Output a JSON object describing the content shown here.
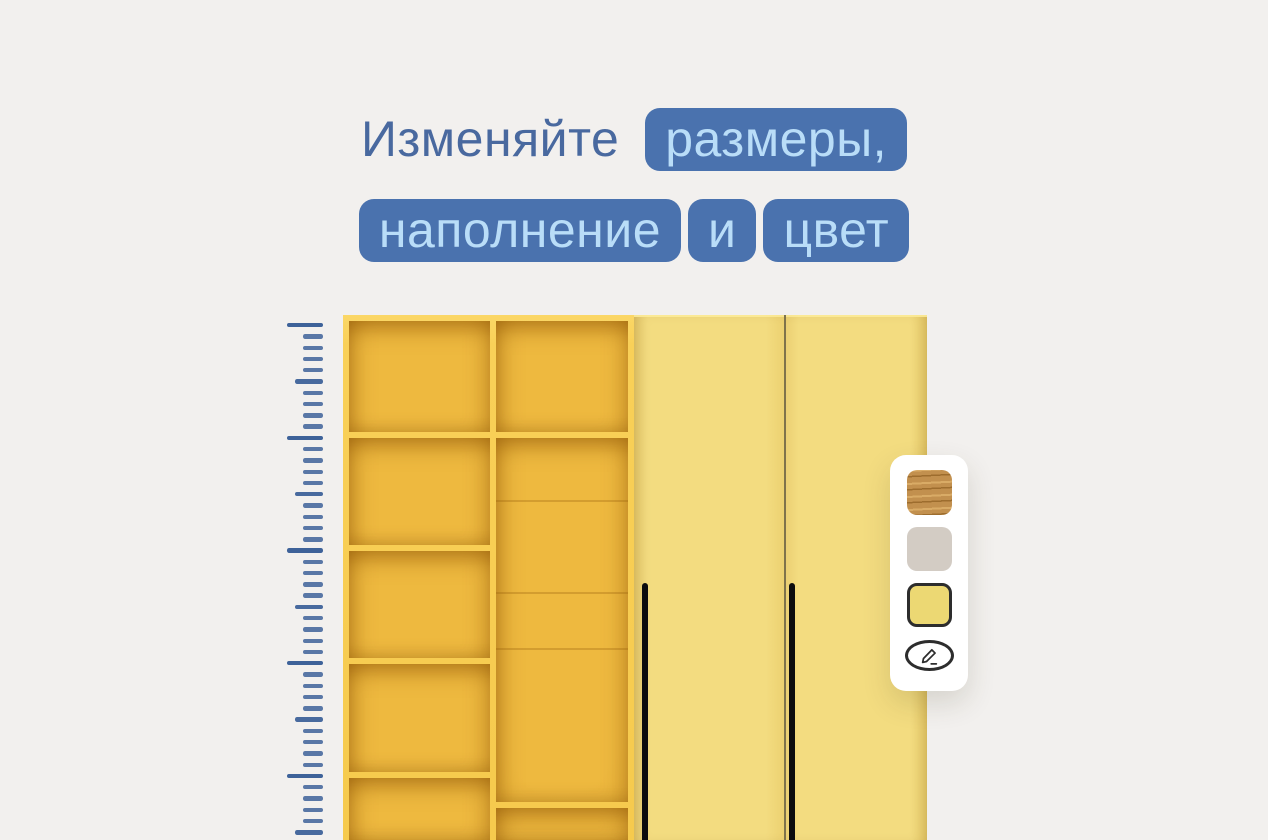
{
  "headline": {
    "line1": [
      {
        "text": "Изменяйте",
        "style": "plain"
      },
      {
        "text": "размеры,",
        "style": "pill"
      }
    ],
    "line2": [
      {
        "text": "наполнение",
        "style": "pill"
      },
      {
        "text": "и",
        "style": "pill"
      },
      {
        "text": "цвет",
        "style": "pill"
      }
    ]
  },
  "colors": {
    "background": "#f2f0ee",
    "headline_text": "#49699f",
    "pill_background": "#4a72ae",
    "pill_text": "#b9ddf8",
    "ruler_tick": "#3e6299",
    "shelf_frame": "#f9d058",
    "shelf_inner": "#eeb93f",
    "door": "#f3dc80",
    "door_gap": "#6b5d2e",
    "handle": "#0c0c0e",
    "panel_background": "#ffffff",
    "swatch_border_selected": "#2d2d2d",
    "icon_outline": "#2d2d2d",
    "wood_base": "#c2904e",
    "wood_dark": "#9d6d2e",
    "wood_light": "#d9ab66"
  },
  "ruler": {
    "tick_count": 46,
    "tick_spacing_px": 11.27,
    "major_every": 10,
    "medium_every": 5
  },
  "wardrobe": {
    "sections": [
      "open-shelving",
      "door-left",
      "door-right"
    ],
    "handles": 2
  },
  "color_panel": {
    "swatches": [
      {
        "name": "oak-wood",
        "type": "texture",
        "selected": false
      },
      {
        "name": "greige",
        "type": "solid",
        "color": "#d3ccc4",
        "selected": false
      },
      {
        "name": "yellow",
        "type": "solid",
        "color": "#ecd873",
        "selected": true
      }
    ],
    "edit_icon": "pencil-edit-icon"
  }
}
